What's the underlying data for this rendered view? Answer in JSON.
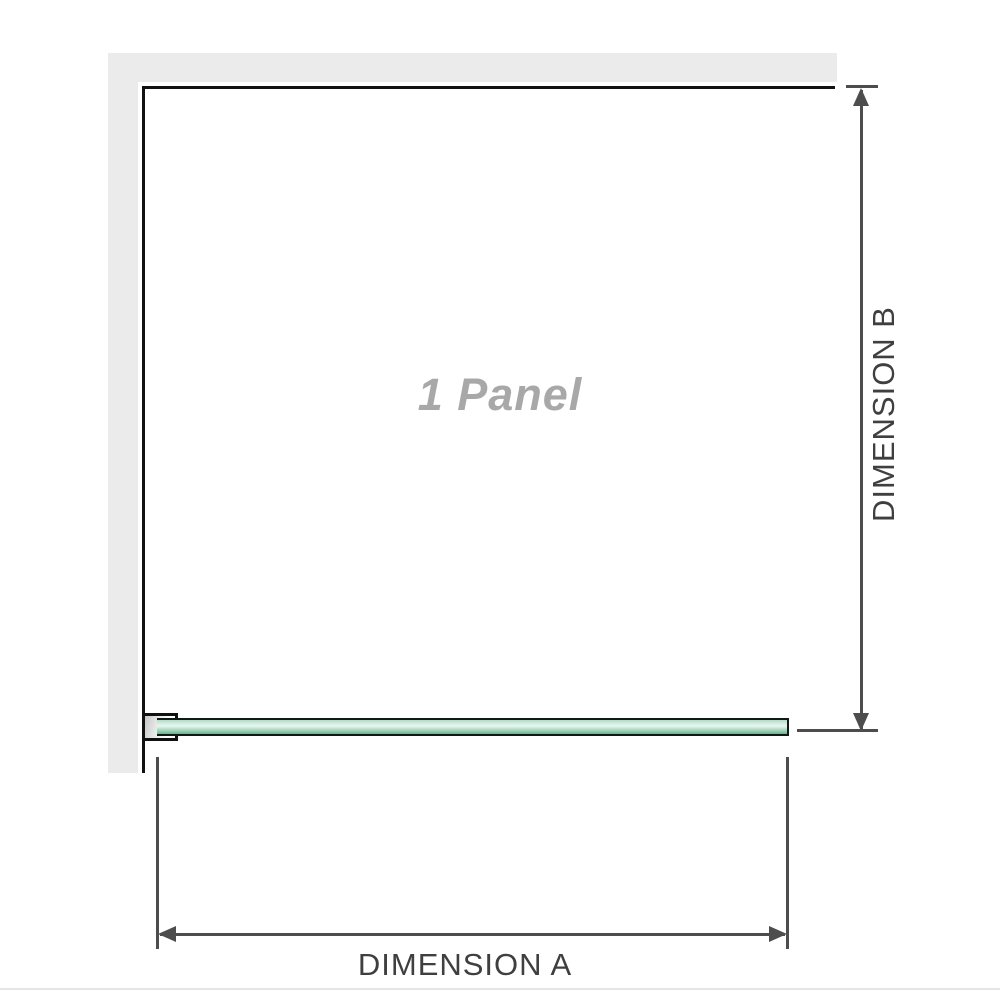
{
  "diagram": {
    "title": "1 Panel shower screen dimension diagram",
    "panel_label": "1 Panel",
    "dimension_a_label": "DIMENSION A",
    "dimension_b_label": "DIMENSION B"
  },
  "colors": {
    "background": "#ffffff",
    "wall_fill": "#ebebeb",
    "panel_outline": "#121212",
    "dimension_line": "#4d4d4d",
    "dimension_label_text": "#3f3f3f",
    "panel_label_text": "#a8a8a8",
    "glass_fill_green": "#a9d8c0",
    "glass_highlight": "#e9f5ef",
    "glass_border": "#101a14",
    "bracket_fill": "#e9e9e9",
    "bottom_divider": "#e5e5e5"
  },
  "icons": {
    "arrow_up": "dimension arrowhead pointing up",
    "arrow_down": "dimension arrowhead pointing down",
    "arrow_left": "dimension arrowhead pointing left",
    "arrow_right": "dimension arrowhead pointing right"
  }
}
